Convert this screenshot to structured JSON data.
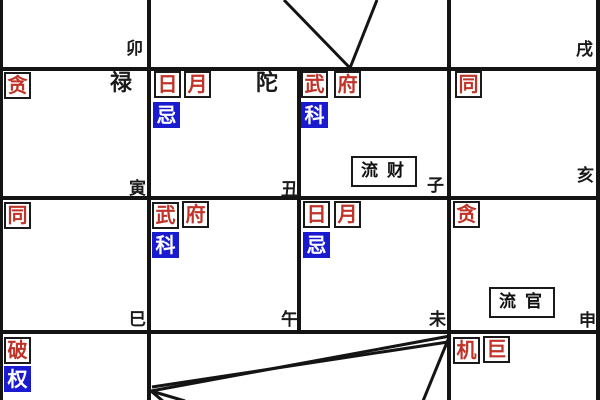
{
  "palette": {
    "star_red": "#c03328",
    "transform_blue": "#1a1ace",
    "grid_black": "#141414",
    "background": "#ffffff"
  },
  "palaces": {
    "mao": {
      "branch": "卯"
    },
    "xu": {
      "branch": "戌"
    },
    "yin": {
      "stars": [
        "贪"
      ],
      "aux": "禄",
      "branch": "寅"
    },
    "chou": {
      "stars": [
        "日",
        "月"
      ],
      "transform": "忌",
      "aux": "陀",
      "branch": "丑"
    },
    "zi": {
      "stars": [
        "武",
        "府"
      ],
      "transform": "科",
      "flow": "流财",
      "branch": "子"
    },
    "hai": {
      "stars": [
        "同"
      ],
      "branch": "亥"
    },
    "si": {
      "stars": [
        "同"
      ],
      "branch": "巳"
    },
    "wu": {
      "stars": [
        "武",
        "府"
      ],
      "transform": "科",
      "branch": "午"
    },
    "wei": {
      "stars": [
        "日",
        "月"
      ],
      "transform": "忌",
      "branch": "未"
    },
    "shen": {
      "stars": [
        "贪"
      ],
      "flow": "流官",
      "branch": "申"
    },
    "r4c1": {
      "stars": [
        "破"
      ],
      "transform": "权"
    },
    "r4c4": {
      "stars": [
        "机",
        "巨"
      ]
    }
  },
  "flying_lines": [
    {
      "x1": 284,
      "y1": 0,
      "x2": 350,
      "y2": 68
    },
    {
      "x1": 377,
      "y1": 0,
      "x2": 350,
      "y2": 68
    },
    {
      "x1": 450,
      "y1": 336,
      "x2": 151,
      "y2": 391
    },
    {
      "x1": 448,
      "y1": 342,
      "x2": 152,
      "y2": 387
    },
    {
      "x1": 151,
      "y1": 391,
      "x2": 185,
      "y2": 401
    },
    {
      "x1": 151,
      "y1": 391,
      "x2": 164,
      "y2": 402
    },
    {
      "x1": 450,
      "y1": 335,
      "x2": 423,
      "y2": 401
    }
  ]
}
